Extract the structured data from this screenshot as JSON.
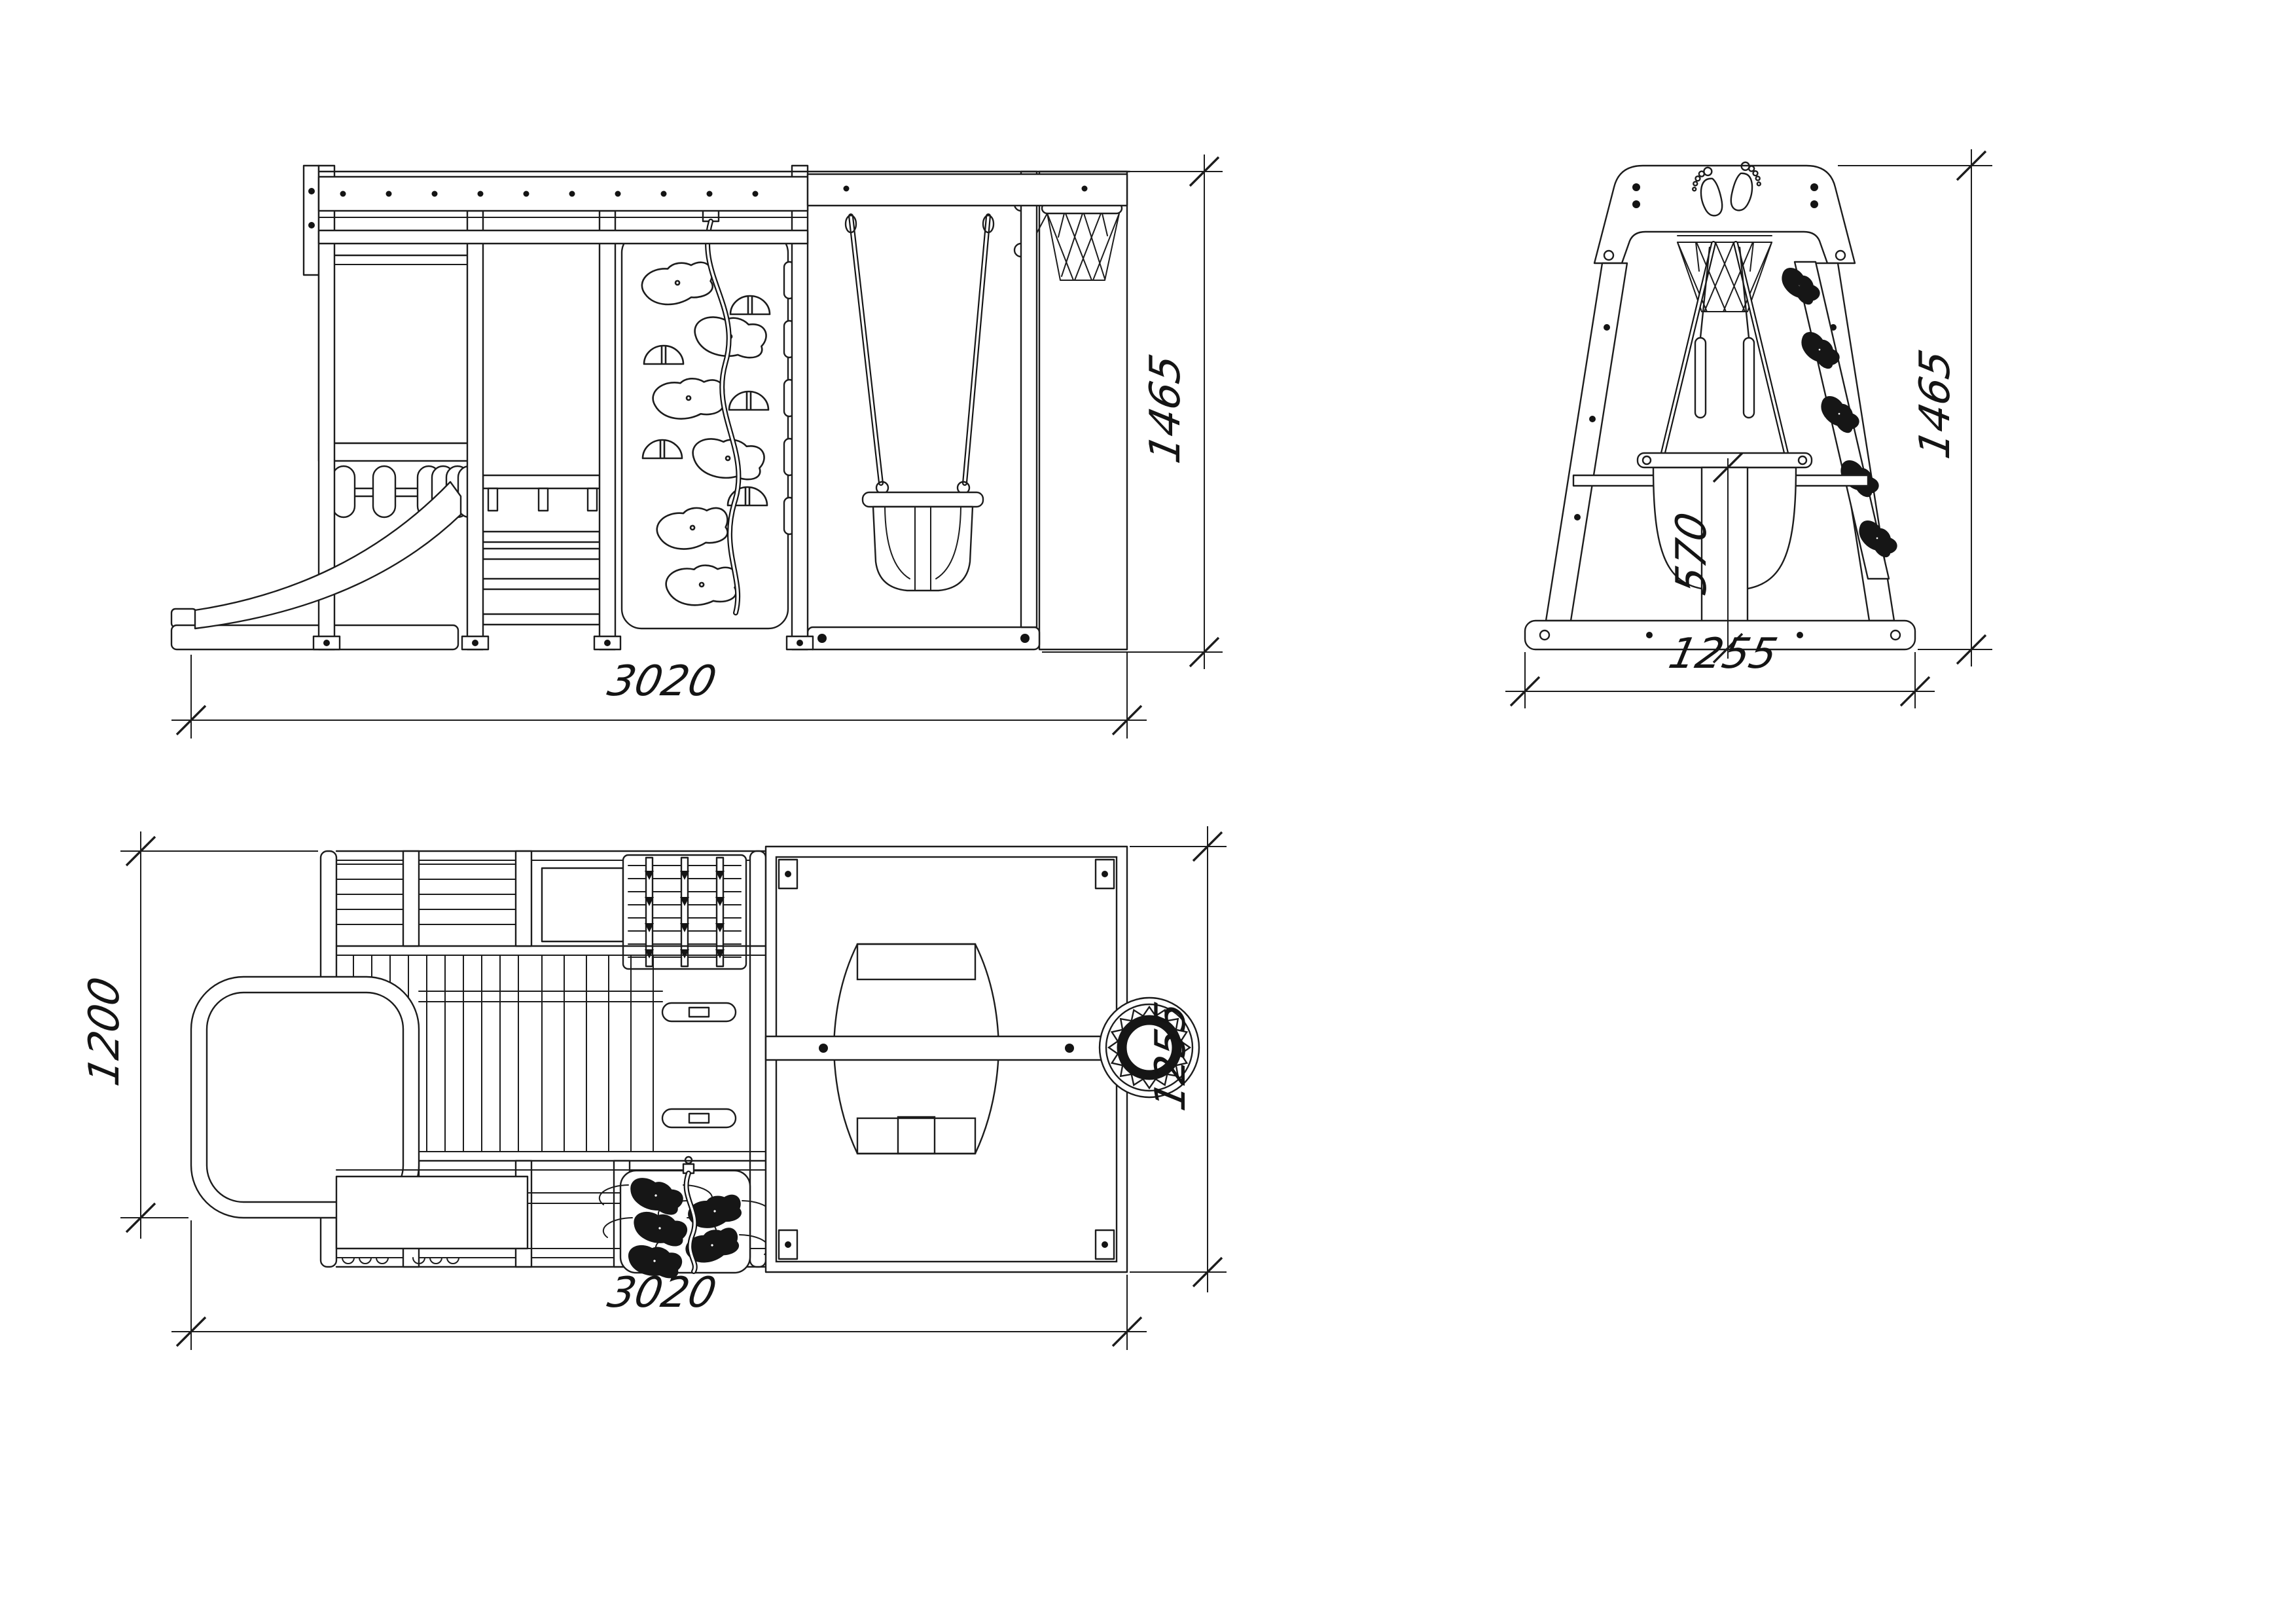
{
  "drawing": {
    "background": "#ffffff",
    "line_color": "#1c1c1c",
    "icons": {
      "footprints": "footprints-icon",
      "basketball_net_front": "basketball-net-icon",
      "basketball_net_side": "basketball-net-icon",
      "basketball_hoop_plan": "basketball-hoop-icon"
    },
    "views": {
      "front": {
        "label_width": "3020",
        "label_height": "1465"
      },
      "side": {
        "label_width": "1255",
        "label_height": "1465",
        "label_inner": "570"
      },
      "plan": {
        "label_depth": "1200",
        "label_width": "3020",
        "label_side": "1255"
      }
    }
  }
}
